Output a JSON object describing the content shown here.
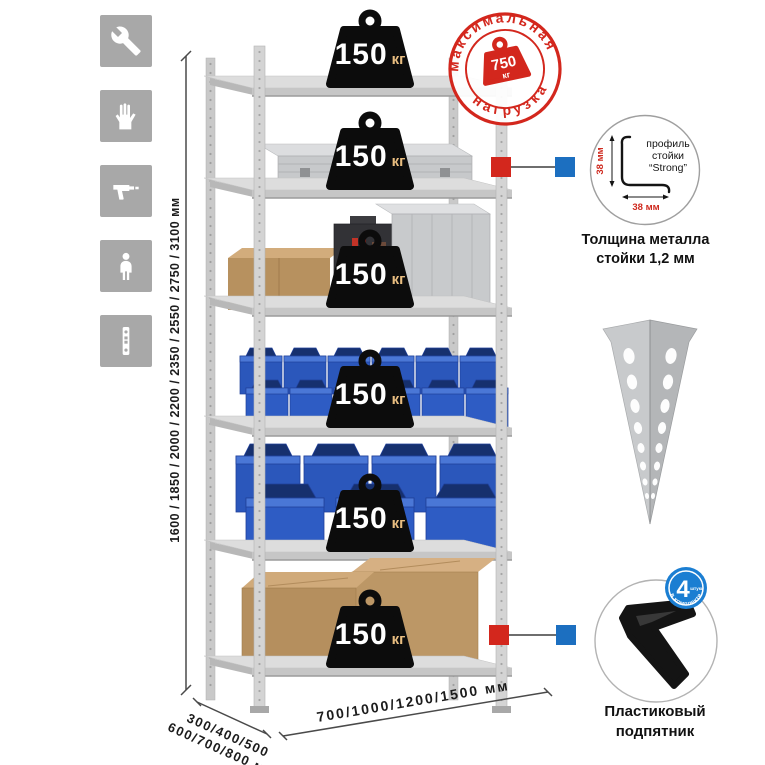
{
  "assembly_icons": [
    {
      "name": "wrench"
    },
    {
      "name": "gloves"
    },
    {
      "name": "drill"
    },
    {
      "name": "person"
    },
    {
      "name": "perforated-upright"
    }
  ],
  "dimensions": {
    "height": "1600 / 1850 / 2000 / 2200 / 2350 / 2550 / 2750 / 3100 мм",
    "depth_line1": "300/400/500",
    "depth_line2": "600/700/800 мм",
    "width": "700/1000/1200/1500 мм"
  },
  "max_load_stamp": {
    "arc_top": "максимальная",
    "arc_bottom": "нагрузка",
    "value": "750",
    "unit": "кг"
  },
  "shelves": [
    {
      "load": "150",
      "unit": "кг"
    },
    {
      "load": "150",
      "unit": "кг"
    },
    {
      "load": "150",
      "unit": "кг"
    },
    {
      "load": "150",
      "unit": "кг"
    },
    {
      "load": "150",
      "unit": "кг"
    },
    {
      "load": "150",
      "unit": "кг"
    }
  ],
  "profile_detail": {
    "label_line1": "профиль",
    "label_line2": "стойки",
    "label_line3": "“Strong”",
    "dim_vertical": "38 мм",
    "dim_horizontal": "38 мм",
    "caption_line1": "Толщина металла",
    "caption_line2": "стойки 1,2 мм"
  },
  "foot_detail": {
    "badge_value": "4",
    "badge_small": "штуки",
    "badge_arc": "в комплекте",
    "caption_line1": "Пластиковый",
    "caption_line2": "подпятник"
  },
  "colors": {
    "stamp_red": "#d3271d",
    "marker_red": "#d3271d",
    "marker_blue": "#1c6fc0",
    "bin_blue": "#2b57bb",
    "badge_black": "#0c0c0c",
    "icon_gray": "#a8a8a8",
    "foot_badge_blue": "#1b7ed2"
  }
}
